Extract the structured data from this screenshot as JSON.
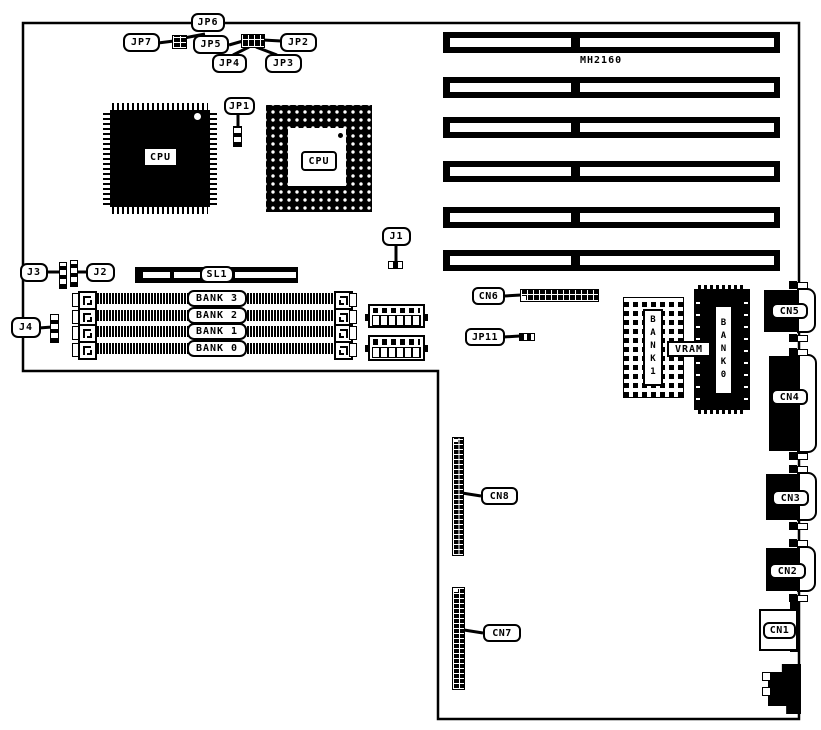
{
  "board": {
    "part_number": "MH2160"
  },
  "cpus": {
    "qfp_label": "CPU",
    "pga_label": "CPU"
  },
  "jumpers": {
    "jp1": "JP1",
    "jp2": "JP2",
    "jp3": "JP3",
    "jp4": "JP4",
    "jp5": "JP5",
    "jp6": "JP6",
    "jp7": "JP7",
    "jp11": "JP11",
    "j1": "J1",
    "j2": "J2",
    "j3": "J3",
    "j4": "J4"
  },
  "slot": {
    "sl1": "SL1"
  },
  "memory": {
    "banks": [
      "BANK 3",
      "BANK 2",
      "BANK 1",
      "BANK 0"
    ],
    "bank1_chip": "BANK1",
    "bank0_chip": "BANK0",
    "vram": "VRAM"
  },
  "connectors": {
    "cn1": "CN1",
    "cn2": "CN2",
    "cn3": "CN3",
    "cn4": "CN4",
    "cn5": "CN5",
    "cn6": "CN6",
    "cn7": "CN7",
    "cn8": "CN8"
  },
  "colors": {
    "ink": "#000000",
    "background": "#ffffff"
  }
}
